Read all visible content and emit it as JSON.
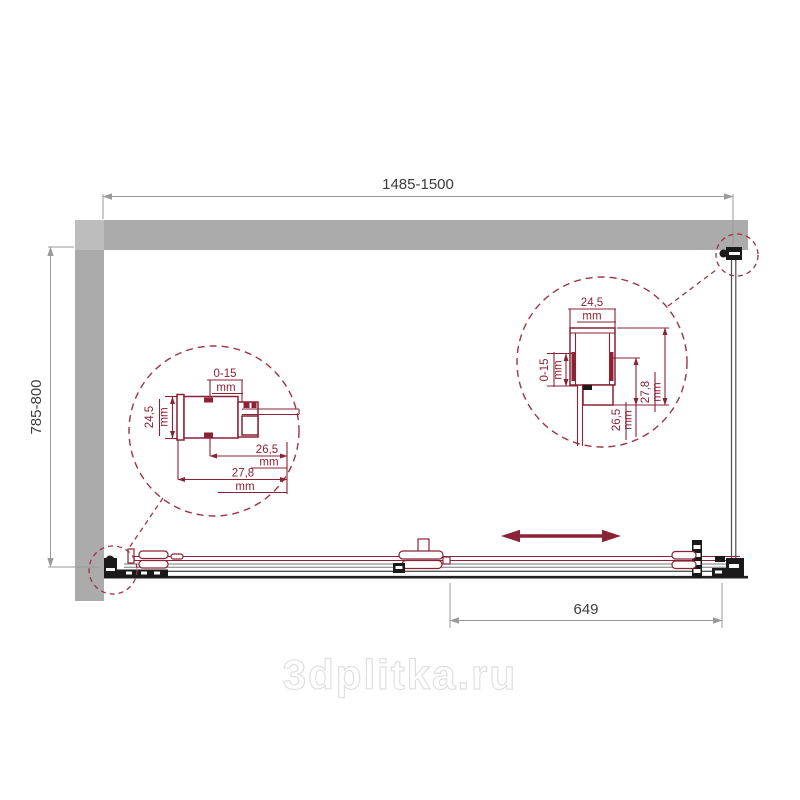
{
  "dims": {
    "width": "1485-1500",
    "height": "785-800",
    "door": "649"
  },
  "details": {
    "range": "0-15",
    "size": "24,5",
    "inner": "26,5",
    "outer": "27,8",
    "unit": "mm"
  },
  "watermark": {
    "text": "3dplitka.ru"
  },
  "colors": {
    "wall": "#ababab",
    "wall-light": "#bdbdbd",
    "accent": "#8c2236",
    "dashed": "#a03246",
    "dim-line": "#9a9a9a",
    "dim-text": "#3c3c3c",
    "hardware": "#1a1a1a",
    "glass": "#4d4d4d",
    "wm-stroke": "#e0e0e0"
  }
}
